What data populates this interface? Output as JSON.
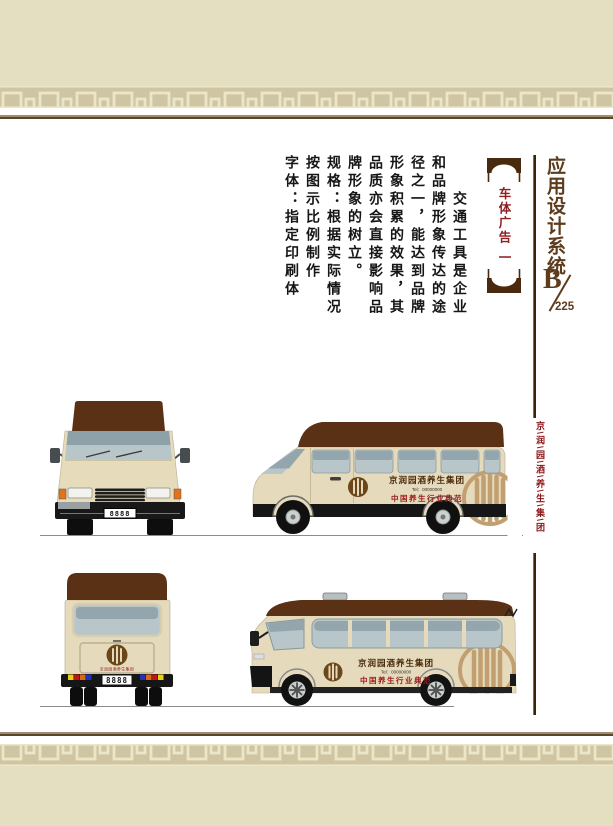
{
  "header": {
    "system_title": "应用设计系统",
    "section_letter": "B",
    "page_number": "225"
  },
  "section_label": {
    "title": "车体广告",
    "number": "一"
  },
  "body_text": {
    "para1": "　　交通工具是企业和品牌形象传达的途径之一，能达到品牌形象积累的效果，其品质亦会直接影响品牌形象的树立。",
    "para2": "规格：根据实际情况按图示比例制作",
    "para3": "字体：指定印刷体"
  },
  "side_note": "京\\润\\园\\酒\\养\\生\\集\\团",
  "vehicles": {
    "company_name": "京润园酒养生集团",
    "tel": "Tel：00000000",
    "slogan": "中国养生行业典范",
    "front_plate": "8888",
    "rear_plate": "8888",
    "rear_caption": "京润园酒养生集团"
  },
  "colors": {
    "band_beige": "#e5dfc1",
    "meander_tan": "#cfc5a2",
    "rule_brown": "#5a4630",
    "title_brown": "#5d3b1d",
    "label_red": "#8e1f22",
    "roof_brown": "#5a3115",
    "body_cream": "#e5dabb",
    "accent_red": "#9c1c1c",
    "logo_brown": "#6b4619",
    "watermark_tan": "#c19f70"
  }
}
